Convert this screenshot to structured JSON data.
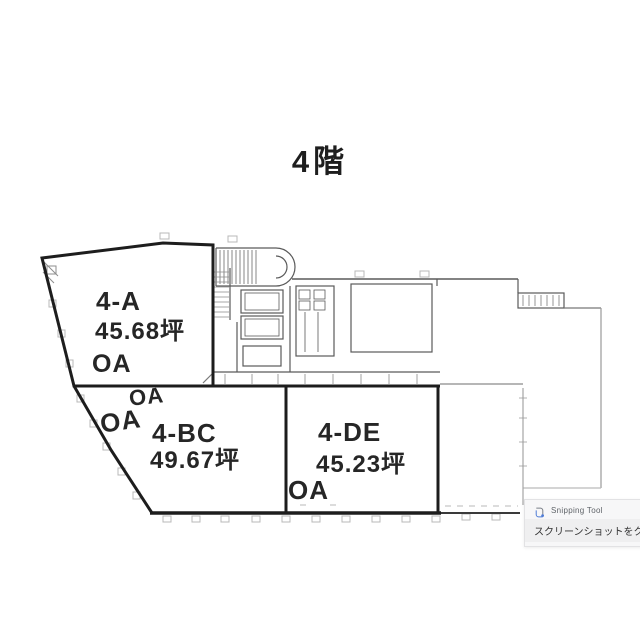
{
  "title": "4階",
  "plan": {
    "rooms": [
      {
        "name": "4-A",
        "area": "45.68坪",
        "oa": "OA"
      },
      {
        "name": "4-BC",
        "area": "49.67坪",
        "oa_upper": "OA",
        "oa_lower": "OA"
      },
      {
        "name": "4-DE",
        "area": "45.23坪",
        "oa": "OA"
      }
    ]
  },
  "toast": {
    "app_name": "Snipping Tool",
    "message": "スクリーンショットをクリップボードにコピー",
    "icon": "snipping-tool-icon"
  },
  "colors": {
    "wall": "#1d1d1d",
    "thin_line": "#555555",
    "light_mark": "#b8b8b8",
    "label_text": "#262626",
    "toast_bg": "#f7f7f8",
    "toast_title": "#5f6368",
    "toast_message": "#323232",
    "toast_icon_blue": "#4f7cd6"
  }
}
